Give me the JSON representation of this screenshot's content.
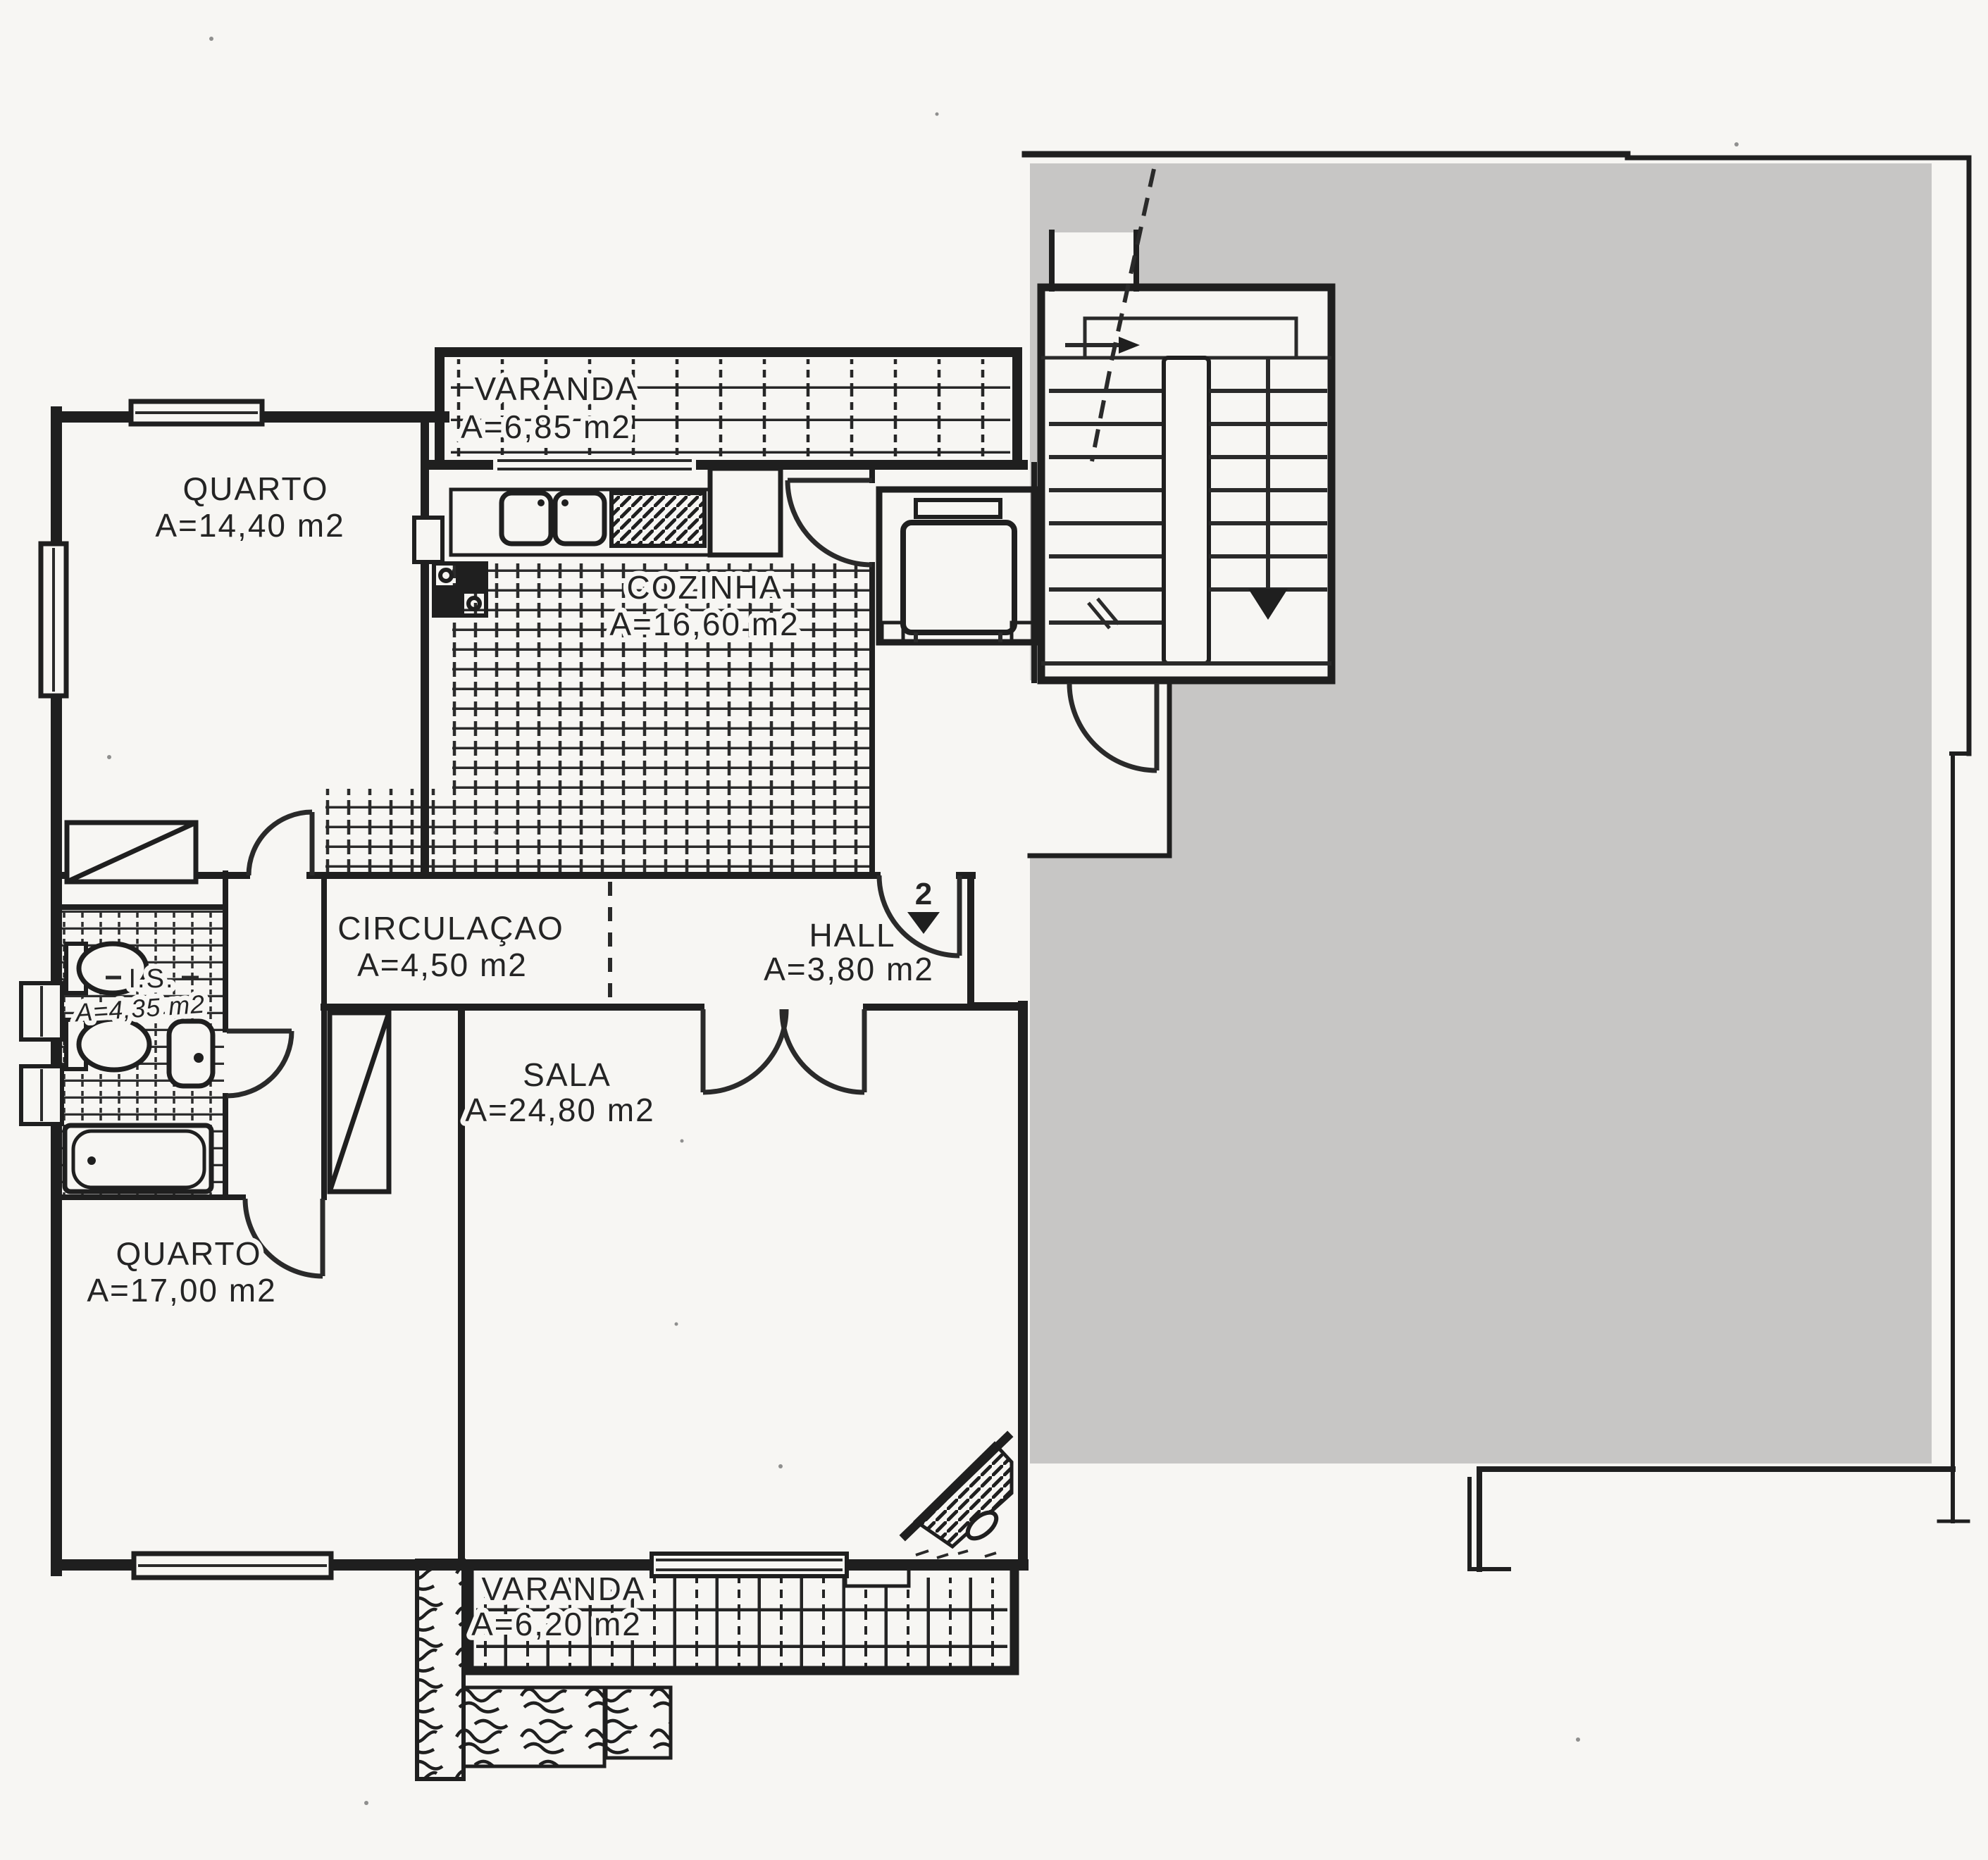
{
  "document": {
    "kind": "scanned apartment floor plan",
    "language": "Portuguese"
  },
  "colors": {
    "paper": "#f7f6f3",
    "ink": "#1f1f1f",
    "redaction_gray": "#c7c6c5"
  },
  "rooms": [
    {
      "name": "VARANDA",
      "area": "A=6,85  m2"
    },
    {
      "name": "QUARTO",
      "area": "A=14,40  m2"
    },
    {
      "name": "COZINHA",
      "area": "A=16,60  m2"
    },
    {
      "name": "CIRCULAÇAO",
      "area": "A=4,50  m2"
    },
    {
      "name": "HALL",
      "area": "A=3,80  m2"
    },
    {
      "name": "I.S.",
      "area": "A=4,35 m2"
    },
    {
      "name": "SALA",
      "area": "A=24,80  m2"
    },
    {
      "name": "QUARTO",
      "area": "A=17,00  m2"
    },
    {
      "name": "VARANDA",
      "area": "A=6,20  m2"
    }
  ],
  "annotations": {
    "entrance_unit": "2"
  }
}
